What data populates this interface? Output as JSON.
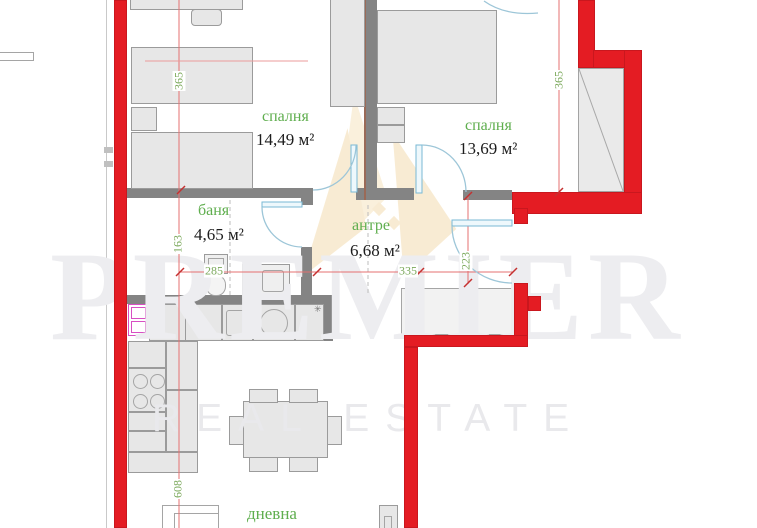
{
  "watermark": {
    "brand": "PREMIER",
    "tagline": "REAL ESTATE"
  },
  "rooms": {
    "bedroom1": {
      "name": "спалня",
      "area": "14,49 м²"
    },
    "bedroom2": {
      "name": "спалня",
      "area": "13,69 м²"
    },
    "bath": {
      "name": "баня",
      "area": "4,65 м²"
    },
    "hall": {
      "name": "антре",
      "area": "6,68 м²"
    },
    "living": {
      "name": "дневна"
    }
  },
  "dims": {
    "bedroom1_depth": "365",
    "bedroom2_depth": "365",
    "bath_depth": "163",
    "living_depth": "608",
    "hall_depth": "223",
    "bath_width": "285",
    "hall_width": "335"
  },
  "kitchen": {
    "marker": "✳"
  },
  "colors": {
    "wall_red": "#e41c23",
    "wall_gray": "#848484",
    "furniture_fill": "#e7e7e7",
    "label_green": "#5fae4e",
    "dim_green": "#7aa85a",
    "dim_line_red": "#e57070",
    "door_blue": "#79b9d4",
    "fridge_pink": "#d84fc3",
    "watermark_gray": "#ededf0",
    "logo_tan": "#eecd8e"
  }
}
